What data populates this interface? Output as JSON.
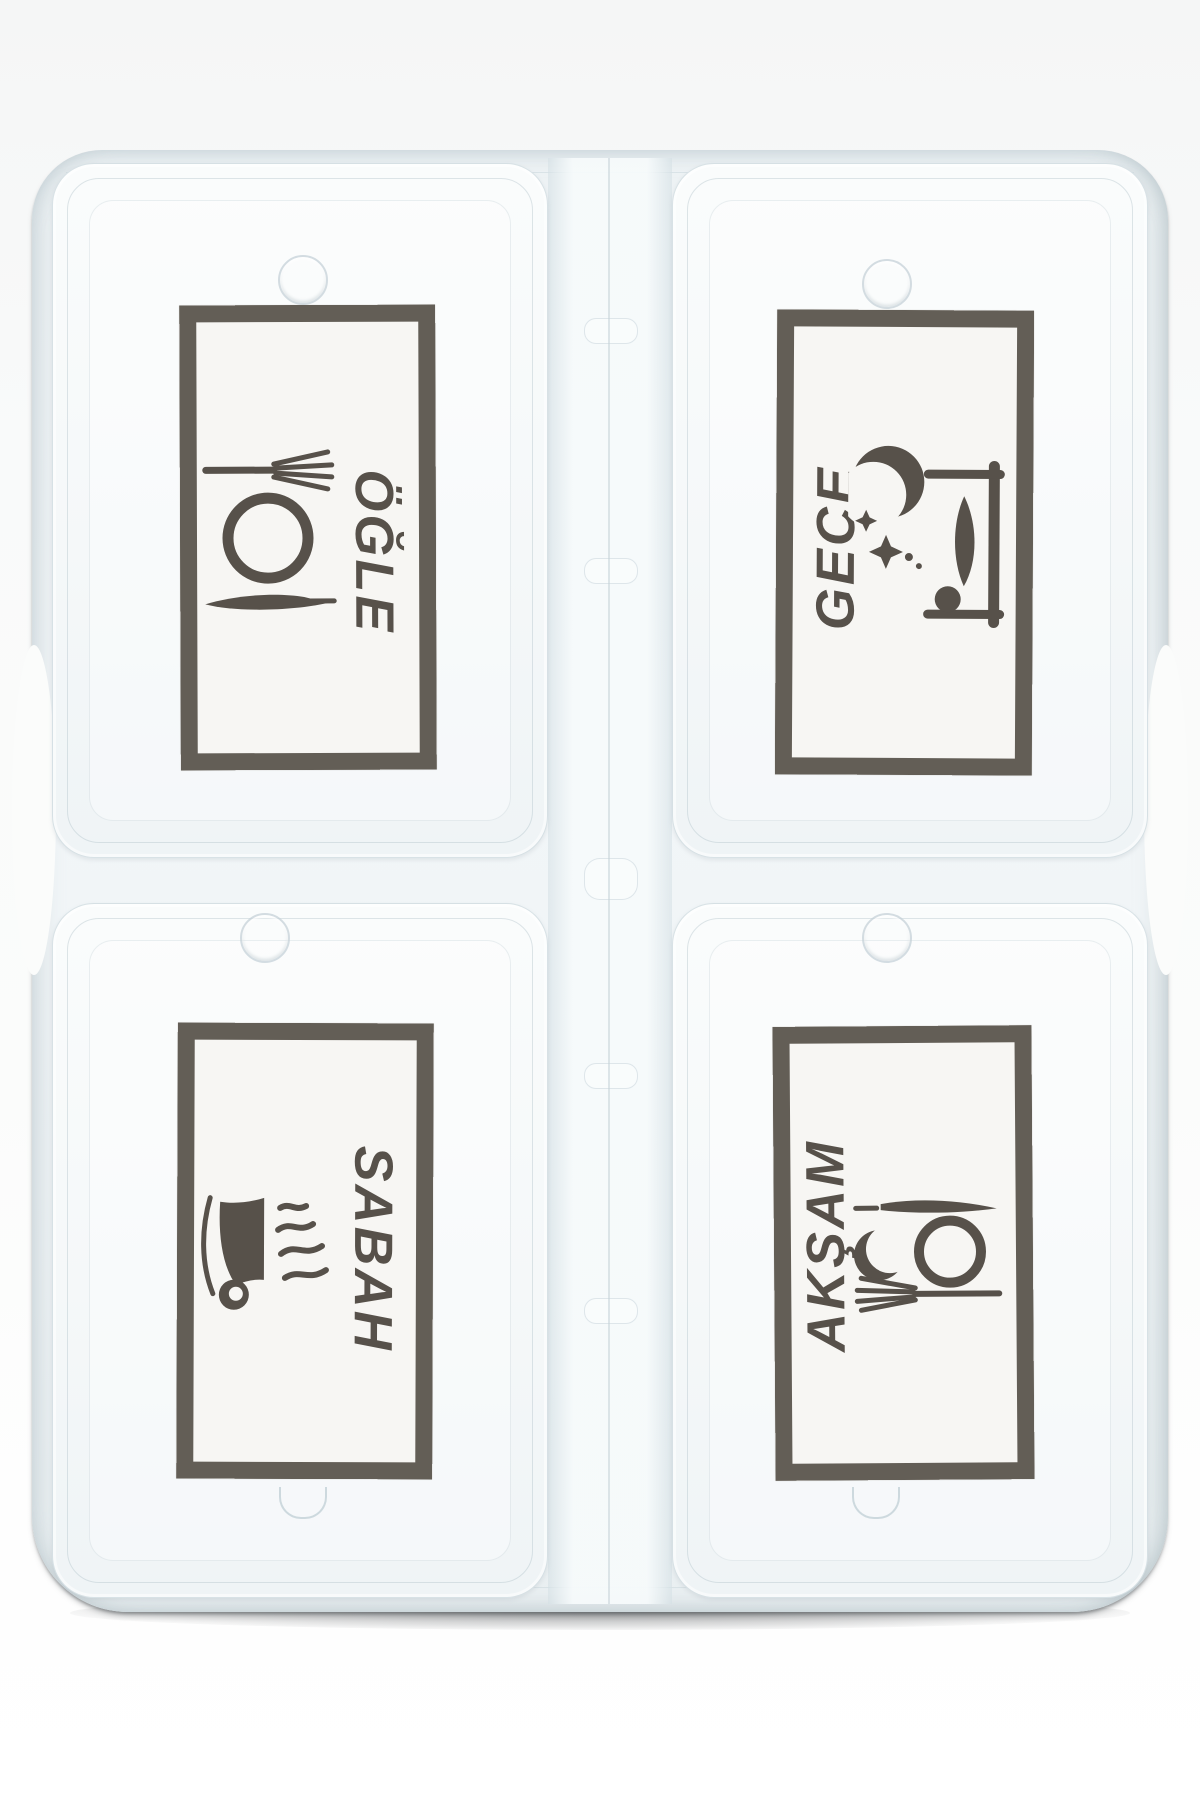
{
  "photo": {
    "subject": "four-compartment translucent pill organizer box",
    "background_color": "#f9fafa",
    "box_tint": "#eef3f5",
    "print_color": "#57514a",
    "label_paper_color": "#f7f6f3"
  },
  "compartments": [
    {
      "position": "top-left",
      "label": "ÖĞLE",
      "icon": "plate-fork-knife-icon",
      "label_rotation": "90cw"
    },
    {
      "position": "top-right",
      "label": "GECE",
      "icon": "bed-moon-stars-icon",
      "label_rotation": "90ccw"
    },
    {
      "position": "bottom-left",
      "label": "SABAH",
      "icon": "steaming-cup-icon",
      "label_rotation": "90cw"
    },
    {
      "position": "bottom-right",
      "label": "AKŞAM",
      "icon": "crescent-plate-fork-knife-icon",
      "label_rotation": "90ccw"
    }
  ]
}
